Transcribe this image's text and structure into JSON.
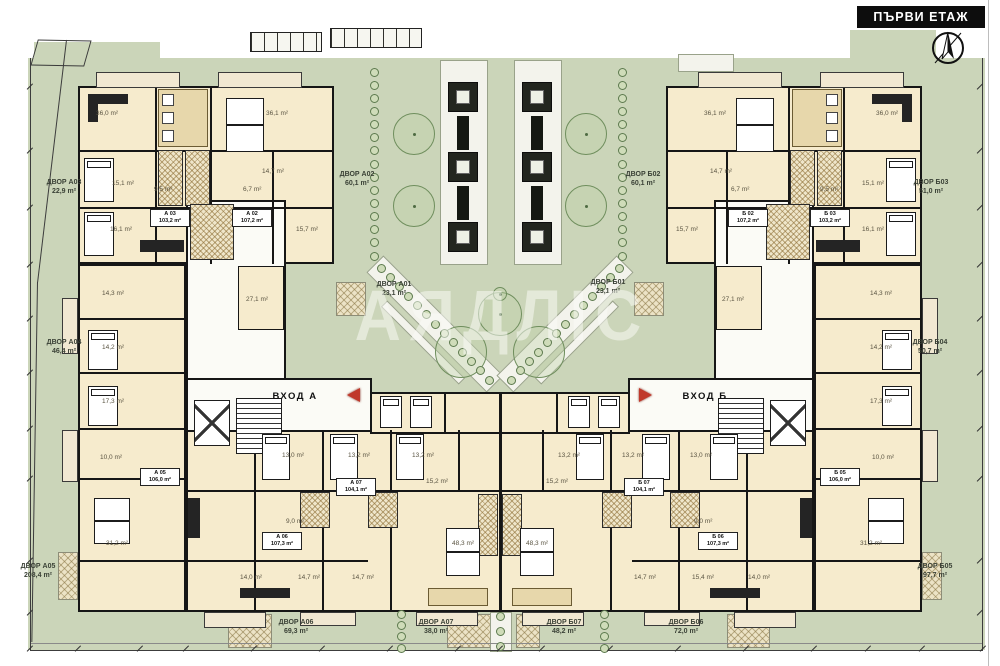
{
  "header": {
    "title": "ПЪРВИ ЕТАЖ"
  },
  "watermark": {
    "text": "АЯДЛIС"
  },
  "entrances": [
    {
      "label": "ВХОД А"
    },
    {
      "label": "ВХОД Б"
    }
  ],
  "yards": [
    {
      "name": "ДВОР A03",
      "area": "22,9 m²",
      "x": 30,
      "y": 178,
      "w": 68
    },
    {
      "name": "ДВОР A02",
      "area": "60,1 m²",
      "x": 322,
      "y": 170,
      "w": 70
    },
    {
      "name": "ДВОР Б02",
      "area": "60,1 m²",
      "x": 608,
      "y": 170,
      "w": 70
    },
    {
      "name": "ДВОР Б03",
      "area": "51,0 m²",
      "x": 896,
      "y": 178,
      "w": 70
    },
    {
      "name": "ДВОР A01",
      "area": "23,1 m²",
      "x": 362,
      "y": 280,
      "w": 64
    },
    {
      "name": "ДВОР Б01",
      "area": "23,1 m²",
      "x": 576,
      "y": 278,
      "w": 64
    },
    {
      "name": "ДВОР A04",
      "area": "46,4 m²",
      "x": 30,
      "y": 338,
      "w": 68
    },
    {
      "name": "ДВОР Б04",
      "area": "50,7 m²",
      "x": 895,
      "y": 338,
      "w": 70
    },
    {
      "name": "ДВОР A05",
      "area": "208,4 m²",
      "x": 6,
      "y": 562,
      "w": 64
    },
    {
      "name": "ДВОР Б05",
      "area": "97,7 m²",
      "x": 898,
      "y": 562,
      "w": 74
    },
    {
      "name": "ДВОР A06",
      "area": "69,3 m²",
      "x": 258,
      "y": 618,
      "w": 76
    },
    {
      "name": "ДВОР A07",
      "area": "38,0 m²",
      "x": 400,
      "y": 618,
      "w": 72
    },
    {
      "name": "ДВОР Б07",
      "area": "48,2 m²",
      "x": 528,
      "y": 618,
      "w": 72
    },
    {
      "name": "ДВОР Б06",
      "area": "72,0 m²",
      "x": 648,
      "y": 618,
      "w": 76
    }
  ],
  "unit_plates": [
    {
      "code": "А 03",
      "area": "103,2 m²",
      "x": 150,
      "y": 209
    },
    {
      "code": "А 02",
      "area": "107,2 m²",
      "x": 232,
      "y": 209
    },
    {
      "code": "Б 02",
      "area": "107,2 m²",
      "x": 728,
      "y": 209
    },
    {
      "code": "Б 03",
      "area": "103,2 m²",
      "x": 810,
      "y": 209
    },
    {
      "code": "А 05",
      "area": "106,0 m²",
      "x": 140,
      "y": 468
    },
    {
      "code": "А 07",
      "area": "104,1 m²",
      "x": 336,
      "y": 478
    },
    {
      "code": "Б 07",
      "area": "104,1 m²",
      "x": 624,
      "y": 478
    },
    {
      "code": "Б 05",
      "area": "106,0 m²",
      "x": 820,
      "y": 468
    },
    {
      "code": "А 06",
      "area": "107,3 m²",
      "x": 262,
      "y": 532
    },
    {
      "code": "Б 06",
      "area": "107,3 m²",
      "x": 698,
      "y": 532
    }
  ],
  "room_labels": [
    {
      "t": "36,0 m²",
      "x": 96,
      "y": 110
    },
    {
      "t": "15,1 m²",
      "x": 112,
      "y": 180
    },
    {
      "t": "16,1 m²",
      "x": 110,
      "y": 226
    },
    {
      "t": "9,5 m²",
      "x": 154,
      "y": 186
    },
    {
      "t": "6,7 m²",
      "x": 243,
      "y": 186
    },
    {
      "t": "14,7 m²",
      "x": 262,
      "y": 168
    },
    {
      "t": "36,1 m²",
      "x": 266,
      "y": 110
    },
    {
      "t": "15,7 m²",
      "x": 296,
      "y": 226
    },
    {
      "t": "36,1 m²",
      "x": 704,
      "y": 110
    },
    {
      "t": "36,0 m²",
      "x": 876,
      "y": 110
    },
    {
      "t": "14,7 m²",
      "x": 710,
      "y": 168
    },
    {
      "t": "15,1 m²",
      "x": 862,
      "y": 180
    },
    {
      "t": "16,1 m²",
      "x": 862,
      "y": 226
    },
    {
      "t": "15,7 m²",
      "x": 676,
      "y": 226
    },
    {
      "t": "9,5 m²",
      "x": 820,
      "y": 186
    },
    {
      "t": "6,7 m²",
      "x": 731,
      "y": 186
    },
    {
      "t": "14,3 m²",
      "x": 102,
      "y": 290
    },
    {
      "t": "14,2 m²",
      "x": 102,
      "y": 344
    },
    {
      "t": "17,3 m²",
      "x": 102,
      "y": 398
    },
    {
      "t": "10,0 m²",
      "x": 100,
      "y": 454
    },
    {
      "t": "31,2 m²",
      "x": 106,
      "y": 540
    },
    {
      "t": "14,3 m²",
      "x": 870,
      "y": 290
    },
    {
      "t": "14,2 m²",
      "x": 870,
      "y": 344
    },
    {
      "t": "17,3 m²",
      "x": 870,
      "y": 398
    },
    {
      "t": "10,0 m²",
      "x": 872,
      "y": 454
    },
    {
      "t": "31,2 m²",
      "x": 860,
      "y": 540
    },
    {
      "t": "27,1 m²",
      "x": 246,
      "y": 296
    },
    {
      "t": "27,1 m²",
      "x": 722,
      "y": 296
    },
    {
      "t": "13,0 m²",
      "x": 282,
      "y": 452
    },
    {
      "t": "13,2 m²",
      "x": 348,
      "y": 452
    },
    {
      "t": "13,2 m²",
      "x": 412,
      "y": 452
    },
    {
      "t": "13,2 m²",
      "x": 558,
      "y": 452
    },
    {
      "t": "13,2 m²",
      "x": 622,
      "y": 452
    },
    {
      "t": "13,0 m²",
      "x": 690,
      "y": 452
    },
    {
      "t": "15,2 m²",
      "x": 426,
      "y": 478
    },
    {
      "t": "15,2 m²",
      "x": 546,
      "y": 478
    },
    {
      "t": "9,0 m²",
      "x": 286,
      "y": 518
    },
    {
      "t": "9,0 m²",
      "x": 694,
      "y": 518
    },
    {
      "t": "48,3 m²",
      "x": 452,
      "y": 540
    },
    {
      "t": "48,3 m²",
      "x": 526,
      "y": 540
    },
    {
      "t": "14,0 m²",
      "x": 240,
      "y": 574
    },
    {
      "t": "14,7 m²",
      "x": 298,
      "y": 574
    },
    {
      "t": "14,7 m²",
      "x": 352,
      "y": 574
    },
    {
      "t": "14,7 m²",
      "x": 634,
      "y": 574
    },
    {
      "t": "15,4 m²",
      "x": 692,
      "y": 574
    },
    {
      "t": "14,0 m²",
      "x": 748,
      "y": 574
    }
  ],
  "colors": {
    "lawn": "#cbd5b9",
    "building_fill": "#f6ebcd",
    "wall": "#161616",
    "accent_red": "#c0392b",
    "title_bg": "#0d0d0d",
    "title_fg": "#ffffff"
  }
}
